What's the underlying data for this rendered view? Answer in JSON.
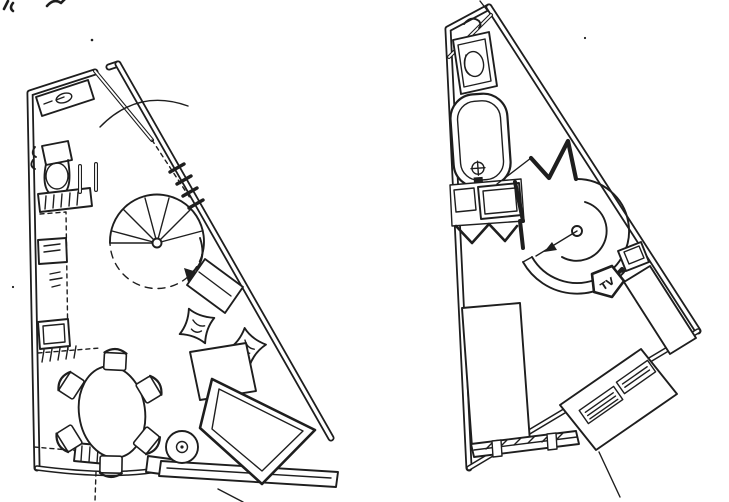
{
  "canvas": {
    "width": 729,
    "height": 502,
    "paper_color": "#ffffff",
    "ink_color": "#1e1e1e"
  },
  "labels": {
    "tv": "TV"
  },
  "plans": [
    {
      "id": "lower-floor-plan",
      "features": [
        "entry-door",
        "corner-shelf",
        "toilet",
        "washbasin-counter",
        "partition-stubs",
        "kitchen-counter",
        "kitchen-appliance",
        "kitchen-sink",
        "spiral-staircase",
        "stair-direction-arrow",
        "window-hatch",
        "side-table",
        "floor-cushion",
        "floor-cushion",
        "low-table",
        "sofa-bed",
        "dining-table",
        "dining-chair-x6",
        "round-stool",
        "balcony-rail",
        "floor-hatch-marks"
      ]
    },
    {
      "id": "upper-floor-plan",
      "features": [
        "corner-shelf-line",
        "toilet",
        "bathtub",
        "bath-faucet",
        "washbasin-vanity",
        "stair-opening-zigzag",
        "partition-wall",
        "spiral-staircase",
        "stair-direction-arrow",
        "tv-stand",
        "nightstand",
        "wardrobe",
        "bed",
        "desk-with-items",
        "low-cabinet"
      ]
    }
  ],
  "annotations": {
    "top_left_marks": "cropped pen squiggles",
    "ink_specks": 3
  }
}
